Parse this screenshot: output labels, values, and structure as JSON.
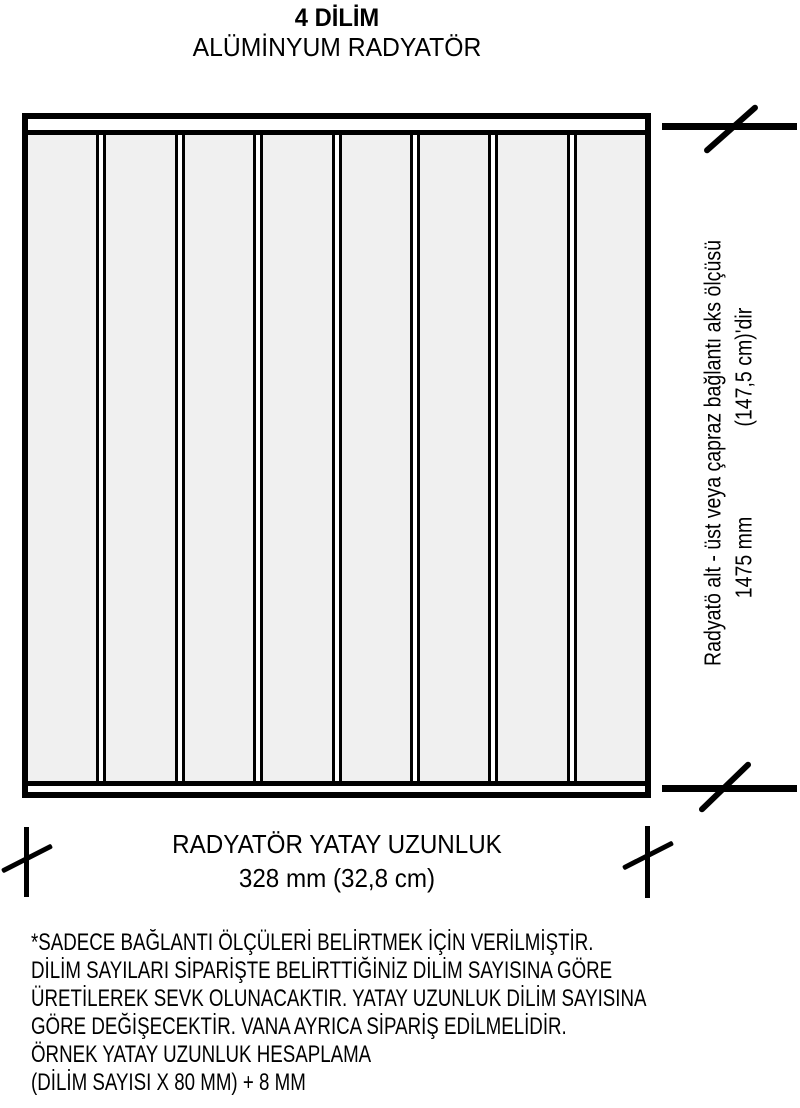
{
  "title": {
    "line1": "4 DİLİM",
    "line2": "ALÜMİNYUM RADYATÖR"
  },
  "diagram": {
    "type": "radiator-front-view",
    "fin_count": 8,
    "fin_fill_color": "#f0f0f0",
    "line_color": "#000000",
    "background_color": "#ffffff"
  },
  "vertical_dimension": {
    "label": "Radyatö alt - üst veya çapraz bağlantı aks ölçüsü",
    "value_mm": "1475 mm",
    "value_cm": "(147,5 cm)'dir"
  },
  "horizontal_dimension": {
    "label": "RADYATÖR YATAY UZUNLUK",
    "value": "328 mm (32,8 cm)"
  },
  "notes": {
    "lines": [
      "*SADECE BAĞLANTI ÖLÇÜLERİ BELİRTMEK İÇİN VERİLMİŞTİR.",
      "DİLİM SAYILARI SİPARİŞTE BELİRTTİĞİNİZ DİLİM SAYISINA GÖRE",
      "ÜRETİLEREK SEVK OLUNACAKTIR. YATAY UZUNLUK DİLİM SAYISINA",
      "GÖRE DEĞİŞECEKTİR. VANA AYRICA SİPARİŞ EDİLMELİDİR.",
      "ÖRNEK YATAY UZUNLUK HESAPLAMA",
      "(DİLİM SAYISI X 80 MM) + 8 MM"
    ]
  }
}
